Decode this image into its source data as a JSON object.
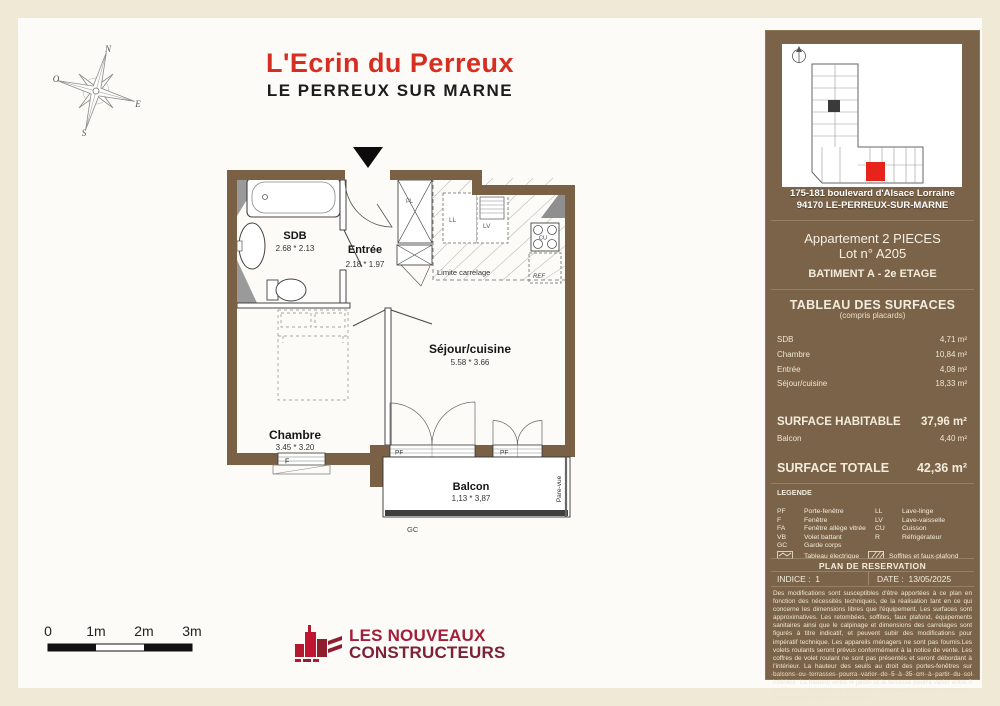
{
  "title": {
    "project": "L'Ecrin du Perreux",
    "city": "LE PERREUX SUR MARNE"
  },
  "compass": {
    "n": "N",
    "s": "S",
    "e": "E",
    "o": "O"
  },
  "plan": {
    "rooms": {
      "sdb": {
        "name": "SDB",
        "dims": "2.68 * 2.13"
      },
      "entree": {
        "name": "Entrée",
        "dims": "2.18 * 1.97"
      },
      "sejour": {
        "name": "Séjour/cuisine",
        "dims": "5.58 * 3.66"
      },
      "chambre": {
        "name": "Chambre",
        "dims": "3.45 * 3.20"
      },
      "balcon": {
        "name": "Balcon",
        "dims": "1,13 * 3,87"
      }
    },
    "annotations": {
      "limite_carrelage": "Limite carrelage",
      "seuil": "Seuil max 15cm",
      "pare_vue": "Pare-vue",
      "gc": "GC",
      "f": "F",
      "pf": "PF",
      "pl": "PL",
      "ll": "LL",
      "lv": "LV",
      "cu": "CU",
      "ref": "REF"
    }
  },
  "scalebar": {
    "labels": [
      "0",
      "1m",
      "2m",
      "3m"
    ]
  },
  "logo": {
    "line1": "LES NOUVEAUX",
    "line2": "CONSTRUCTEURS"
  },
  "sidebar": {
    "address_line1": "175-181 boulevard d'Alsace Lorraine",
    "address_line2": "94170 LE-PERREUX-SUR-MARNE",
    "apartment_type": "Appartement 2 PIECES",
    "lot": "Lot n° A205",
    "building": "BATIMENT A - 2e ETAGE",
    "surfaces_title": "TABLEAU DES SURFACES",
    "surfaces_subtitle": "(compris placards)",
    "rows": [
      {
        "label": "SDB",
        "value": "4,71  m²"
      },
      {
        "label": "Chambre",
        "value": "10,84  m²"
      },
      {
        "label": "Entrée",
        "value": "4,08  m²"
      },
      {
        "label": "Séjour/cuisine",
        "value": "18,33  m²"
      }
    ],
    "habitable_label": "SURFACE HABITABLE",
    "habitable_value": "37,96 m²",
    "balcon_label": "Balcon",
    "balcon_value": "4,40  m²",
    "totale_label": "SURFACE TOTALE",
    "totale_value": "42,36 m²",
    "legend_title": "LEGENDE",
    "legend_col1": [
      [
        "PF",
        "Porte-fenêtre"
      ],
      [
        "F",
        "Fenêtre"
      ],
      [
        "FA",
        "Fenêtre allège vitrée"
      ],
      [
        "VB",
        "Volet battant"
      ],
      [
        "GC",
        "Garde corps"
      ]
    ],
    "legend_col2": [
      [
        "LL",
        "Lave-linge"
      ],
      [
        "LV",
        "Lave-vaisselle"
      ],
      [
        "CU",
        "Cuisson"
      ],
      [
        "R",
        "Réfrigérateur"
      ]
    ],
    "legend_elec": "Tableau électrique",
    "legend_soffites": "Soffites et faux-plafond",
    "plan_reservation": "PLAN DE RESERVATION",
    "indice_label": "INDICE :",
    "indice_value": "1",
    "date_label": "DATE :",
    "date_value": "13/05/2025",
    "disclaimer": "Des modifications sont susceptibles d'être apportées à ce plan en fonction des nécessités techniques, de la réalisation tant en ce qui concerne les dimensions libres que l'équipement. Les surfaces sont approximatives. Les retombées, soffites, faux plafond, équipements sanitaires ainsi que le calpinage et dimensions des carrelages sont figurés à titre indicatif, et peuvent subir des modifications pour impératif technique. Les appareils ménagers ne sont pas fournis.Les volets roulants seront prévus conformément à la notice de vente. Les coffres de volet roulant ne sont pas présentés et seront débordant à l'intérieur.  La hauteur des seuils au droit des portes-fenêtres sur balcons ou terrasses pourra varier de 5 à 35 cm à partir du sol intérieur. La hauteur entre le jardin et la terrasse pourra varier entre 0 et 60 cm. Les jardins ne seront pas nécessairement plats et pourront comporter des talus et des pentes."
  }
}
